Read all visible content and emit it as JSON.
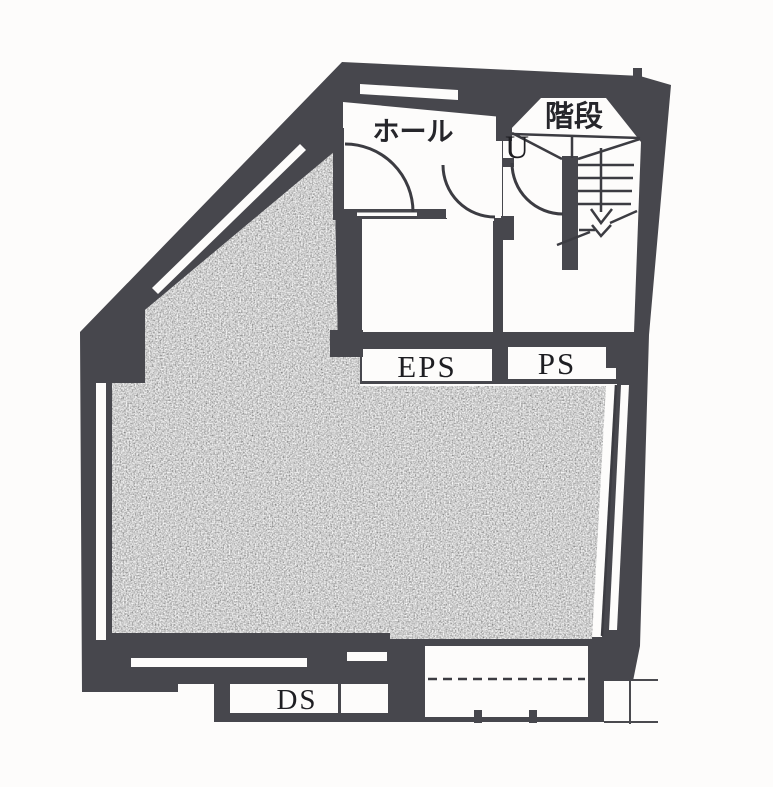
{
  "plan": {
    "title": "floor-plan",
    "labels": {
      "hall": "ホール",
      "stairs": "階段",
      "up_mark": "U",
      "eps": "EPS",
      "ps": "PS",
      "ds": "DS"
    },
    "colors": {
      "paper": "#fdfcfb",
      "wall": "#47474d",
      "line": "#3c3c42",
      "shade_mid": "#949494",
      "text": "#26262b"
    }
  }
}
